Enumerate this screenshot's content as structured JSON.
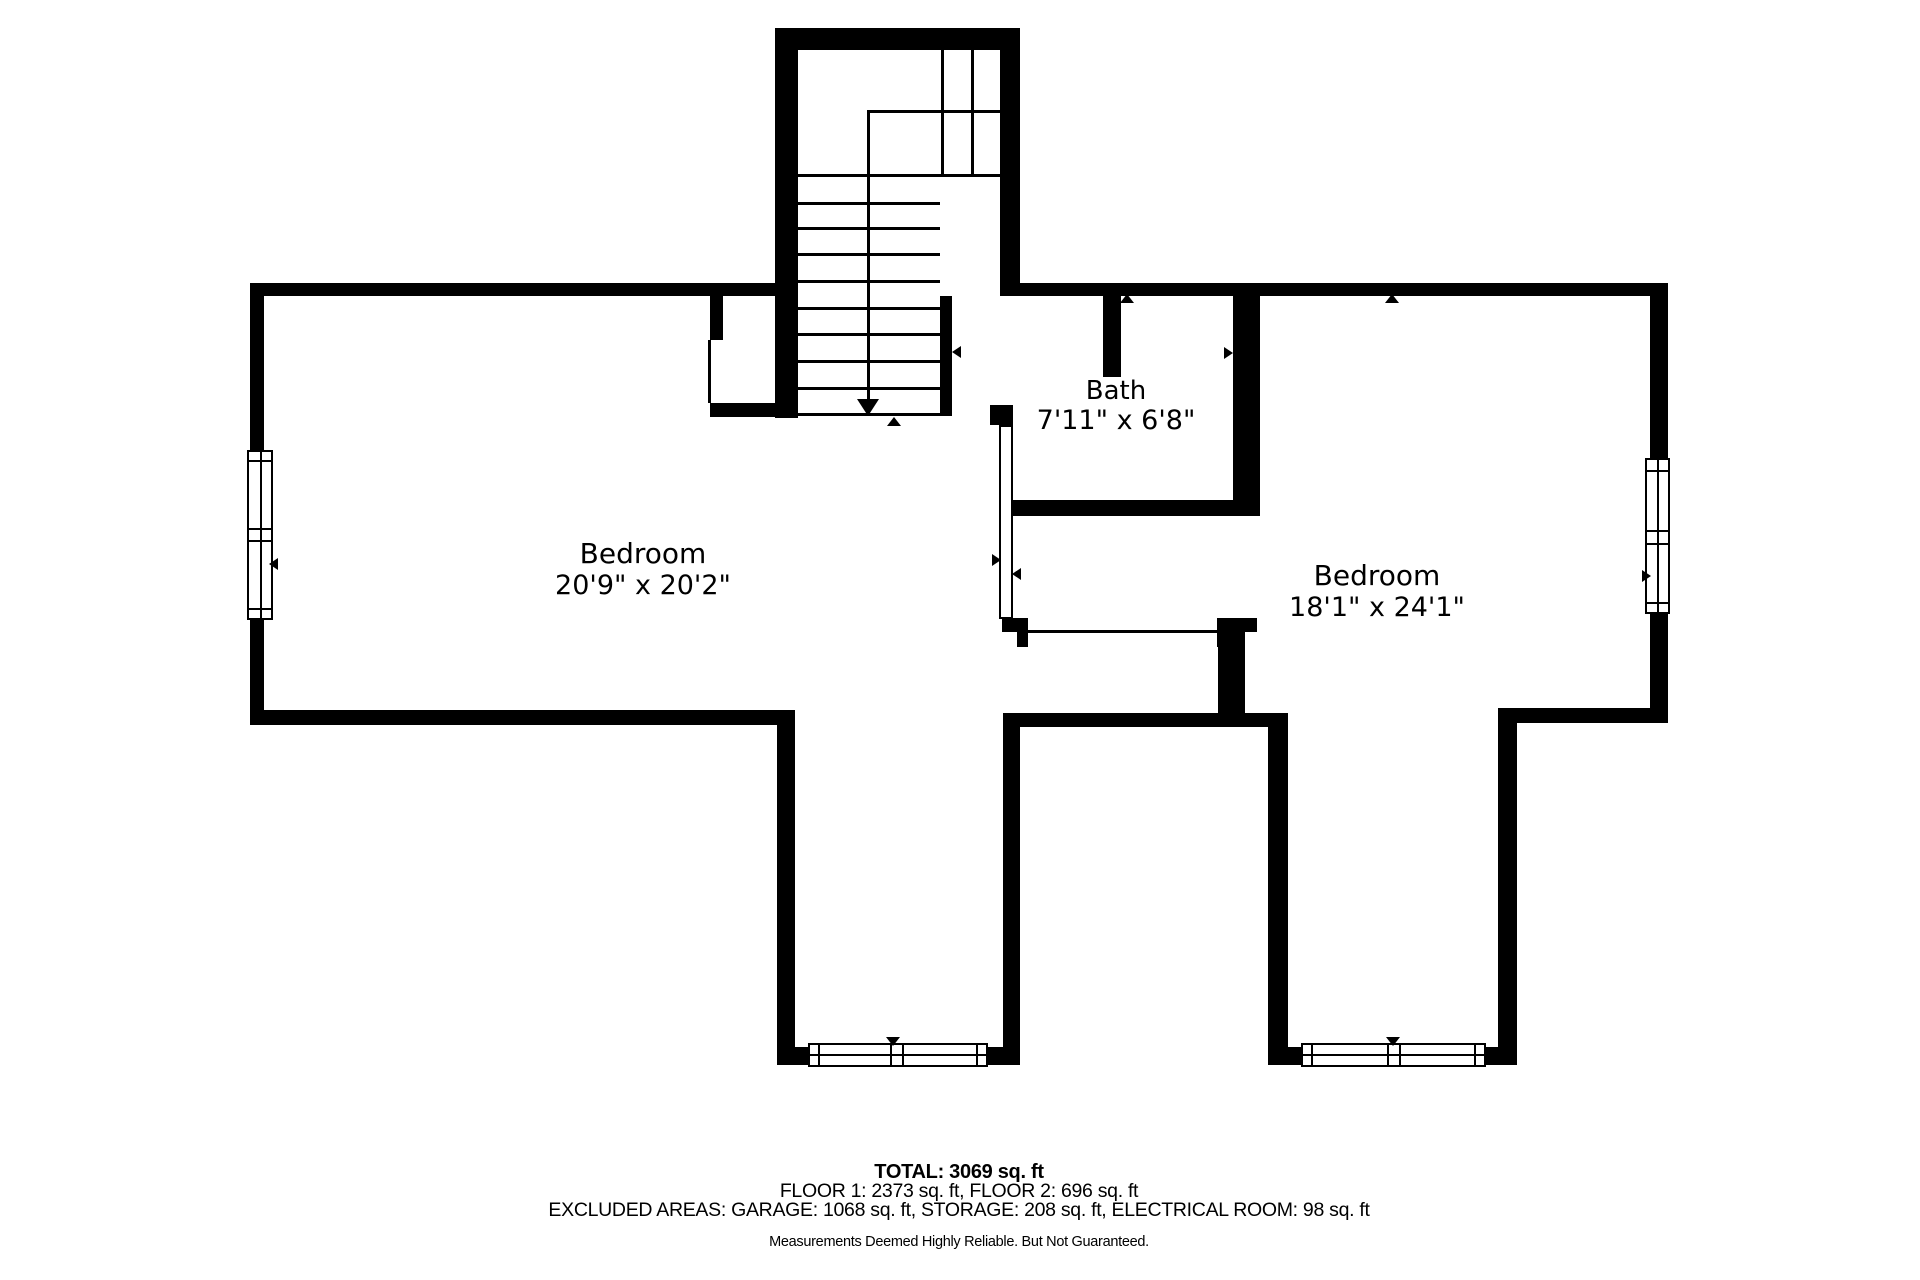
{
  "plan": {
    "title": "Second floor plan",
    "rooms": [
      {
        "id": "bedroom-left",
        "name": "Bedroom",
        "dims": "20'9\" x 20'2\""
      },
      {
        "id": "bedroom-right",
        "name": "Bedroom",
        "dims": "18'1\" x 24'1\""
      },
      {
        "id": "bath",
        "name": "Bath",
        "dims": "7'11\" x 6'8\""
      }
    ],
    "footer": {
      "total": "TOTAL: 3069 sq. ft",
      "floors": "FLOOR 1: 2373 sq. ft, FLOOR 2: 696 sq. ft",
      "excluded": "EXCLUDED AREAS: GARAGE: 1068 sq. ft, STORAGE: 208 sq. ft, ELECTRICAL ROOM: 98 sq. ft",
      "disclaimer": "Measurements Deemed Highly Reliable. But Not Guaranteed."
    },
    "colors": {
      "wall": "#000000",
      "background": "#ffffff",
      "text": "#000000"
    }
  }
}
